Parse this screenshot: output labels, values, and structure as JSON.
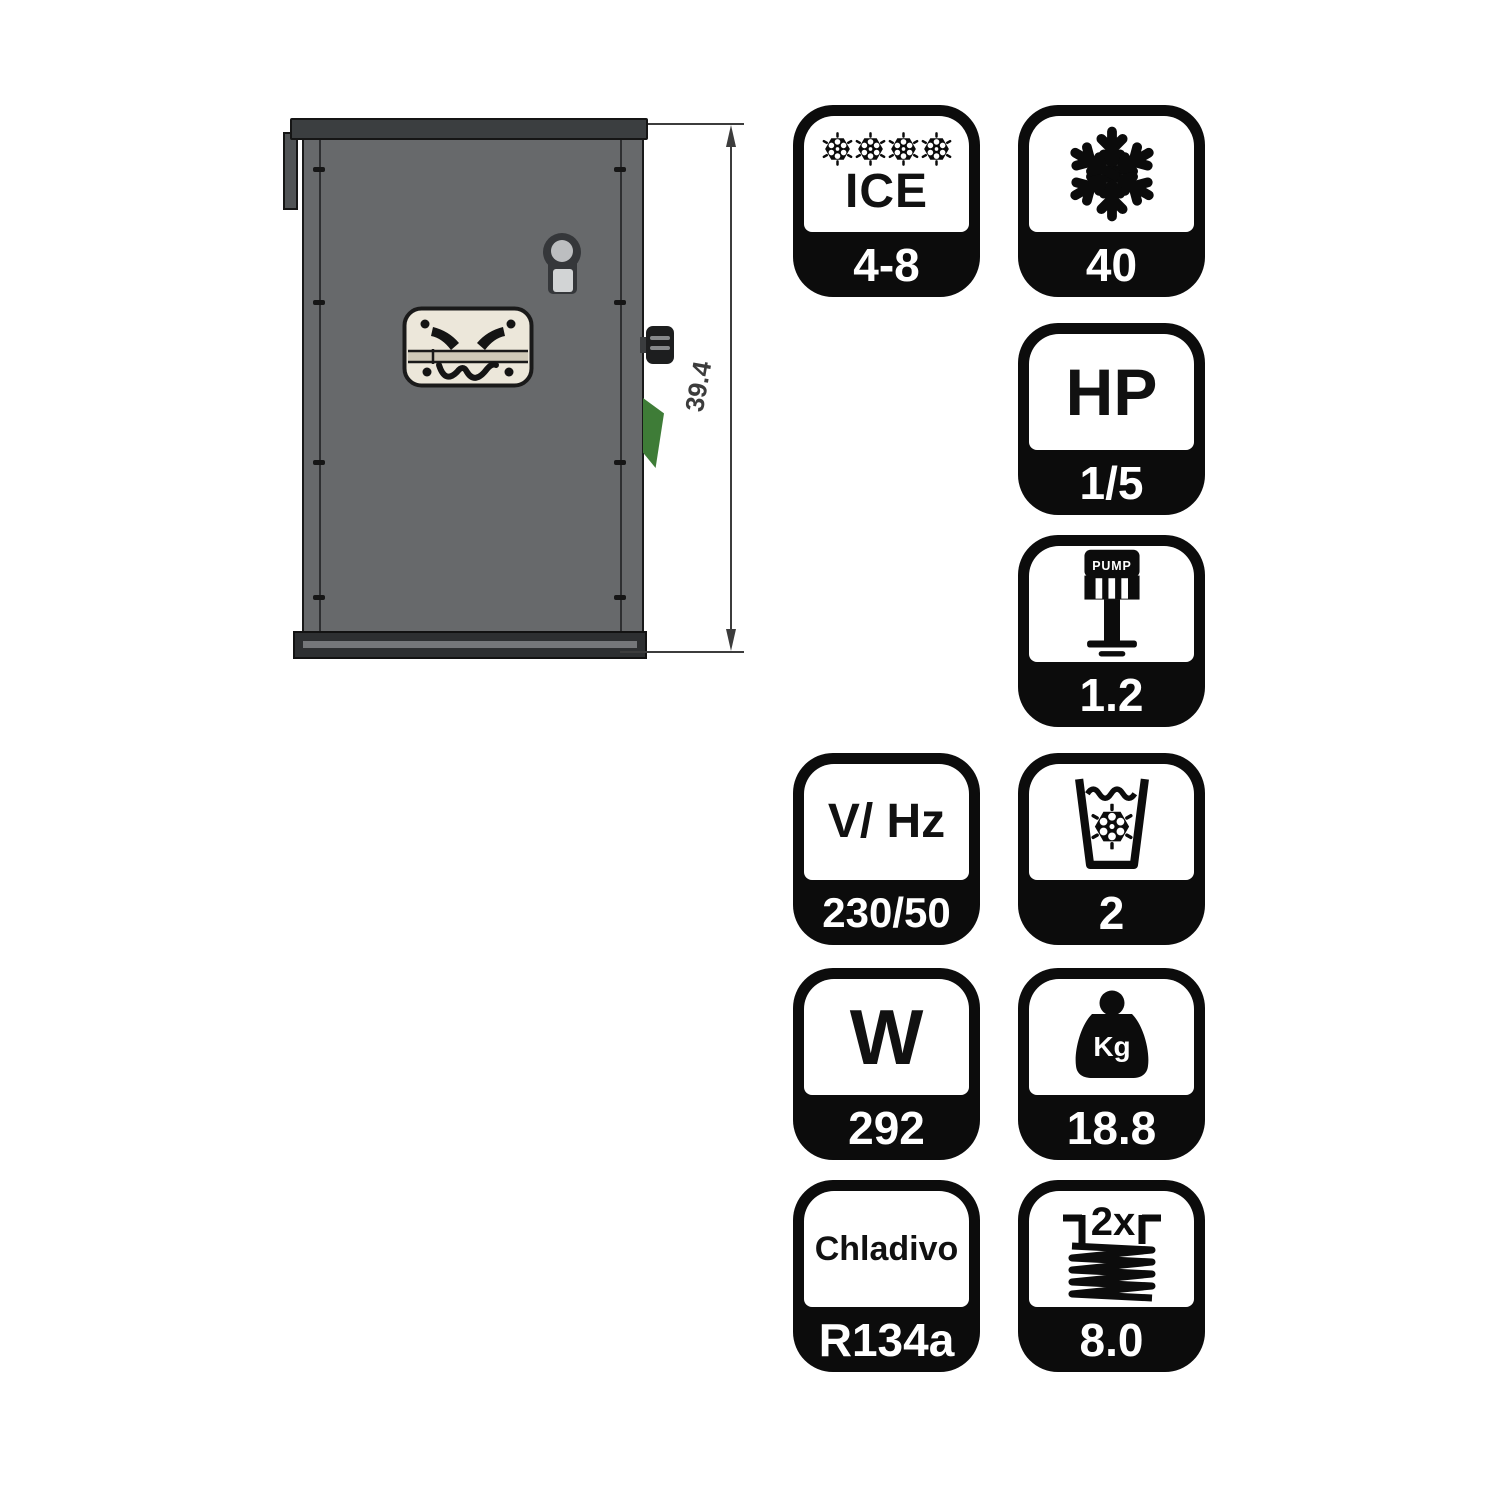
{
  "page": {
    "background": "#ffffff"
  },
  "machine": {
    "description": "ice-maker-cabinet-side-view",
    "dimension_value": "39.4",
    "colors": {
      "body": "#67696b",
      "top_rail": "#3b3e40",
      "base": "#2d2f31",
      "face_plate": "#ece7da",
      "knob": "#1d1e1f",
      "switch_green": "#3e7c37",
      "dimension_line": "#3c3c3c"
    }
  },
  "badge_style": {
    "badge_bg": "#0c0c0c",
    "badge_top_bg": "#ffffff",
    "value_text_color": "#ffffff",
    "top_text_color": "#111111"
  },
  "badges": [
    {
      "name": "ice-cube-size",
      "icon": "ice-rosettes-icon",
      "top_text": "ICE",
      "value": "4-8"
    },
    {
      "name": "daily-production",
      "icon": "snowflake-icon",
      "value": "40"
    },
    {
      "name": "compressor-power",
      "top_text": "HP",
      "value": "1/5"
    },
    {
      "name": "pump",
      "icon": "pump-icon",
      "icon_label": "PUMP",
      "value": "1.2"
    },
    {
      "name": "voltage-frequency",
      "top_text": "V/ Hz",
      "value": "230/50"
    },
    {
      "name": "glass-capacity",
      "icon": "glass-snowflake-icon",
      "value": "2"
    },
    {
      "name": "power-watts",
      "top_text": "W",
      "value": "292"
    },
    {
      "name": "net-weight",
      "icon": "kg-weight-icon",
      "icon_label": "Kg",
      "value": "18.8"
    },
    {
      "name": "refrigerant",
      "top_text": "Chladivo",
      "value": "R134a"
    },
    {
      "name": "condenser-coil",
      "icon": "coil-icon",
      "icon_label": "2x",
      "value": "8.0"
    }
  ]
}
